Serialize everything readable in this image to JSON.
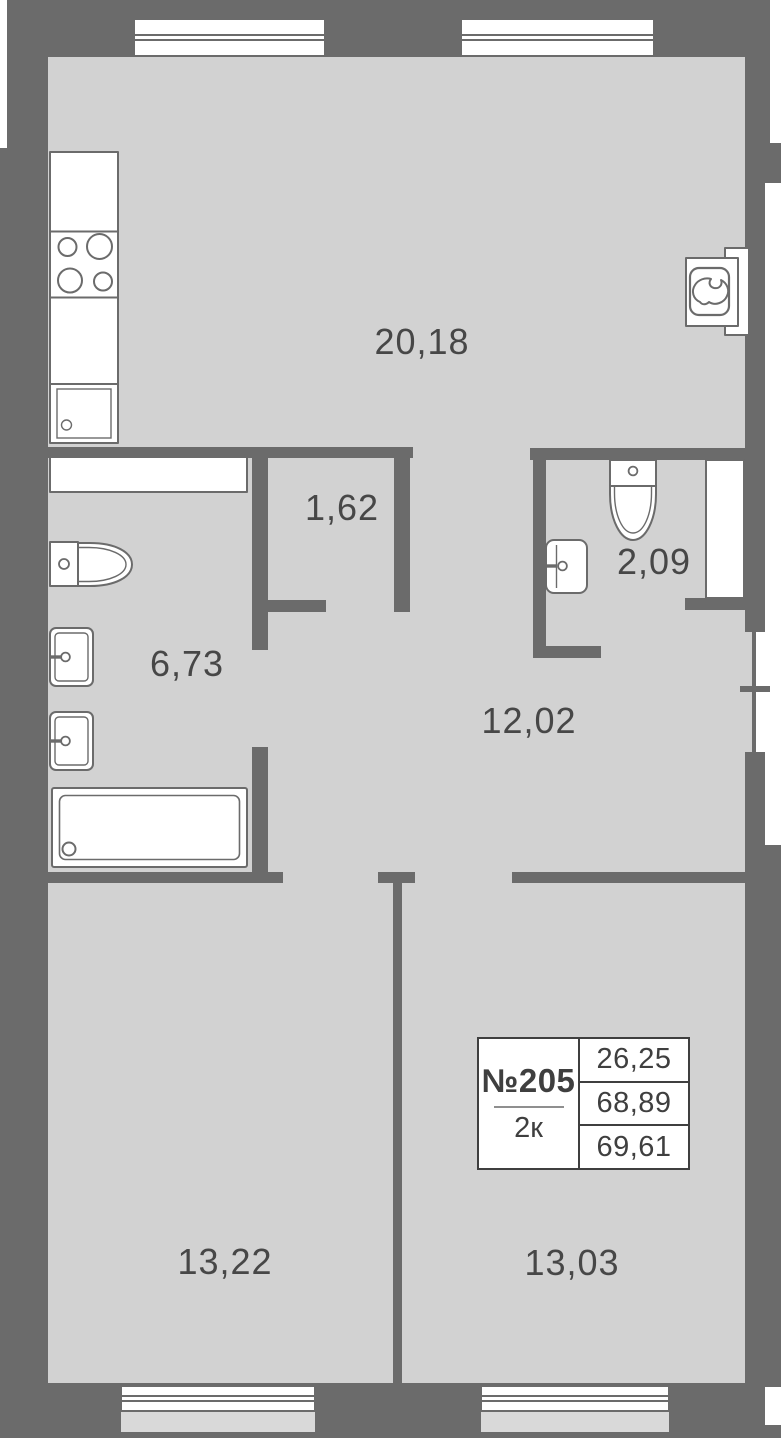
{
  "plan": {
    "unit": {
      "number": "№205",
      "rooms_type": "2к",
      "areas": [
        "26,25",
        "68,89",
        "69,61"
      ]
    },
    "rooms": {
      "kitchen_living": {
        "area": "20,18"
      },
      "closet": {
        "area": "1,62"
      },
      "wc": {
        "area": "2,09"
      },
      "bathroom": {
        "area": "6,73"
      },
      "hallway": {
        "area": "12,02"
      },
      "bedroom_left": {
        "area": "13,22"
      },
      "bedroom_right": {
        "area": "13,03"
      }
    },
    "colors": {
      "wall": "#6b6b6b",
      "floor": "#d2d2d2",
      "exterior_strip": "#d9d9d9",
      "fixture_stroke": "#6b6b6b",
      "label_text": "#474747",
      "info_text": "#3f3f3f"
    }
  }
}
